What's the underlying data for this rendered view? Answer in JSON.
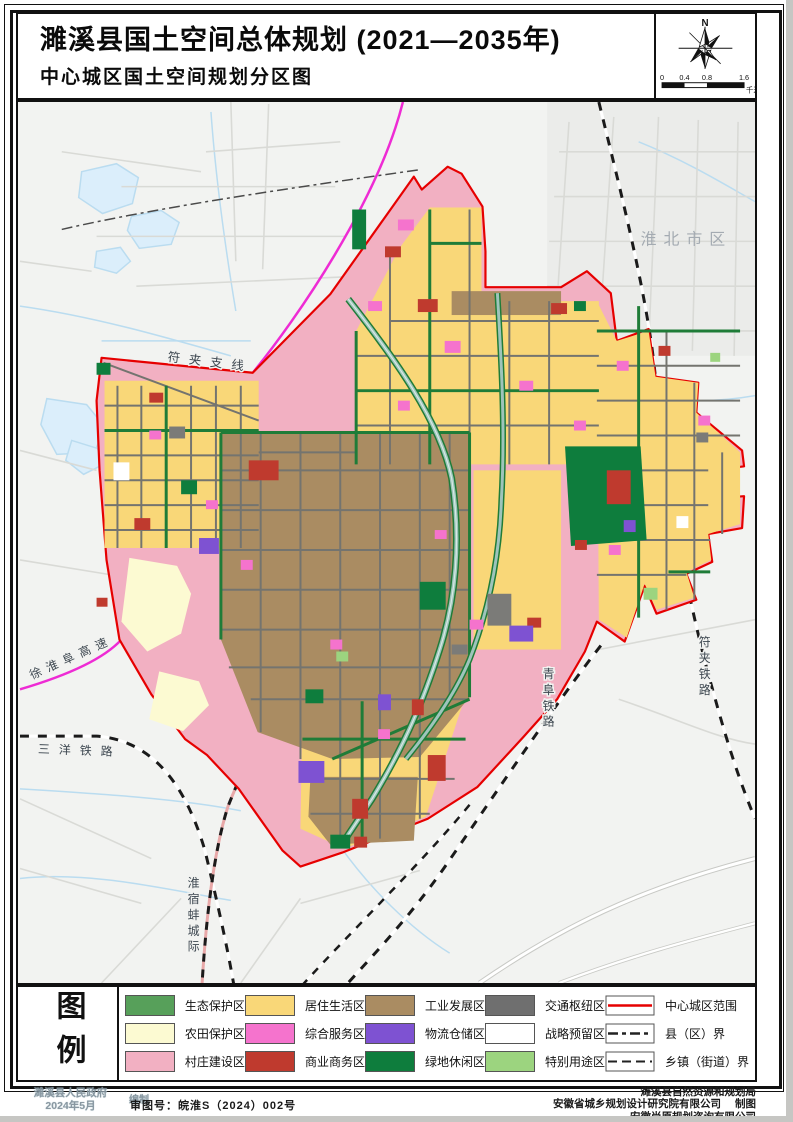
{
  "page": {
    "title": "濉溪县国土空间总体规划 (2021—2035年)",
    "subtitle": "中心城区国土空间规划分区图"
  },
  "compass": {
    "north_label": "N",
    "scale_ticks": [
      "0",
      "0.4",
      "0.8",
      "1.6"
    ],
    "scale_unit": "千米"
  },
  "map_labels": {
    "huaibei_city": "淮北市区",
    "fujia_branch": "符夹支线",
    "xuhuaifu_expressway": "徐淮阜高速",
    "sanyang_railway": "三洋铁路",
    "huaisubeng_intercity": "淮宿蚌城际",
    "qingfu_railway": "青阜铁路",
    "fujia_railway": "符夹铁路"
  },
  "colors": {
    "boundary_red": "#e60000",
    "village_pink": "#f2b0c2",
    "residential_yellow": "#f9d778",
    "industry_brown": "#aa8c62",
    "eco_green": "#57a05a",
    "farmland_cream": "#fcfad2",
    "service_magenta": "#f573cd",
    "commercial_red": "#bf3a2e",
    "logistics_purple": "#7e52d2",
    "hub_gray": "#6f6f6f",
    "greenland_dark_green": "#0e7d3d",
    "special_light_green": "#9cd47f",
    "strategic_white": "#ffffff",
    "expressway_magenta": "#ee2bd4"
  },
  "legend": {
    "title": "图例",
    "items": [
      {
        "label": "生态保护区",
        "color": "#57a05a",
        "type": "fill"
      },
      {
        "label": "农田保护区",
        "color": "#fcfad2",
        "type": "fill"
      },
      {
        "label": "村庄建设区",
        "color": "#f2b0c2",
        "type": "fill"
      },
      {
        "label": "居住生活区",
        "color": "#f9d778",
        "type": "fill"
      },
      {
        "label": "综合服务区",
        "color": "#f573cd",
        "type": "fill"
      },
      {
        "label": "商业商务区",
        "color": "#bf3a2e",
        "type": "fill"
      },
      {
        "label": "工业发展区",
        "color": "#aa8c62",
        "type": "fill"
      },
      {
        "label": "物流仓储区",
        "color": "#7e52d2",
        "type": "fill"
      },
      {
        "label": "绿地休闲区",
        "color": "#0e7d3d",
        "type": "fill"
      },
      {
        "label": "交通枢纽区",
        "color": "#6f6f6f",
        "type": "fill"
      },
      {
        "label": "战略预留区",
        "color": "#ffffff",
        "type": "fill"
      },
      {
        "label": "特别用途区",
        "color": "#9cd47f",
        "type": "fill"
      },
      {
        "label": "中心城区范围",
        "type": "line-red"
      },
      {
        "label": "县（区）界",
        "type": "line-dashdot"
      },
      {
        "label": "乡镇（街道）界",
        "type": "line-dash"
      }
    ]
  },
  "footer": {
    "stamp_line1": "濉溪县人民政府",
    "stamp_line2": "2024年5月",
    "stamp_suffix": "编制",
    "approval": "审图号：皖淮S（2024）002号",
    "credits": [
      "濉溪县自然资源和规划局",
      "安徽省城乡规划设计研究院有限公司",
      "安徽尚原规划咨询有限公司"
    ],
    "credit_suffix": "制图"
  }
}
